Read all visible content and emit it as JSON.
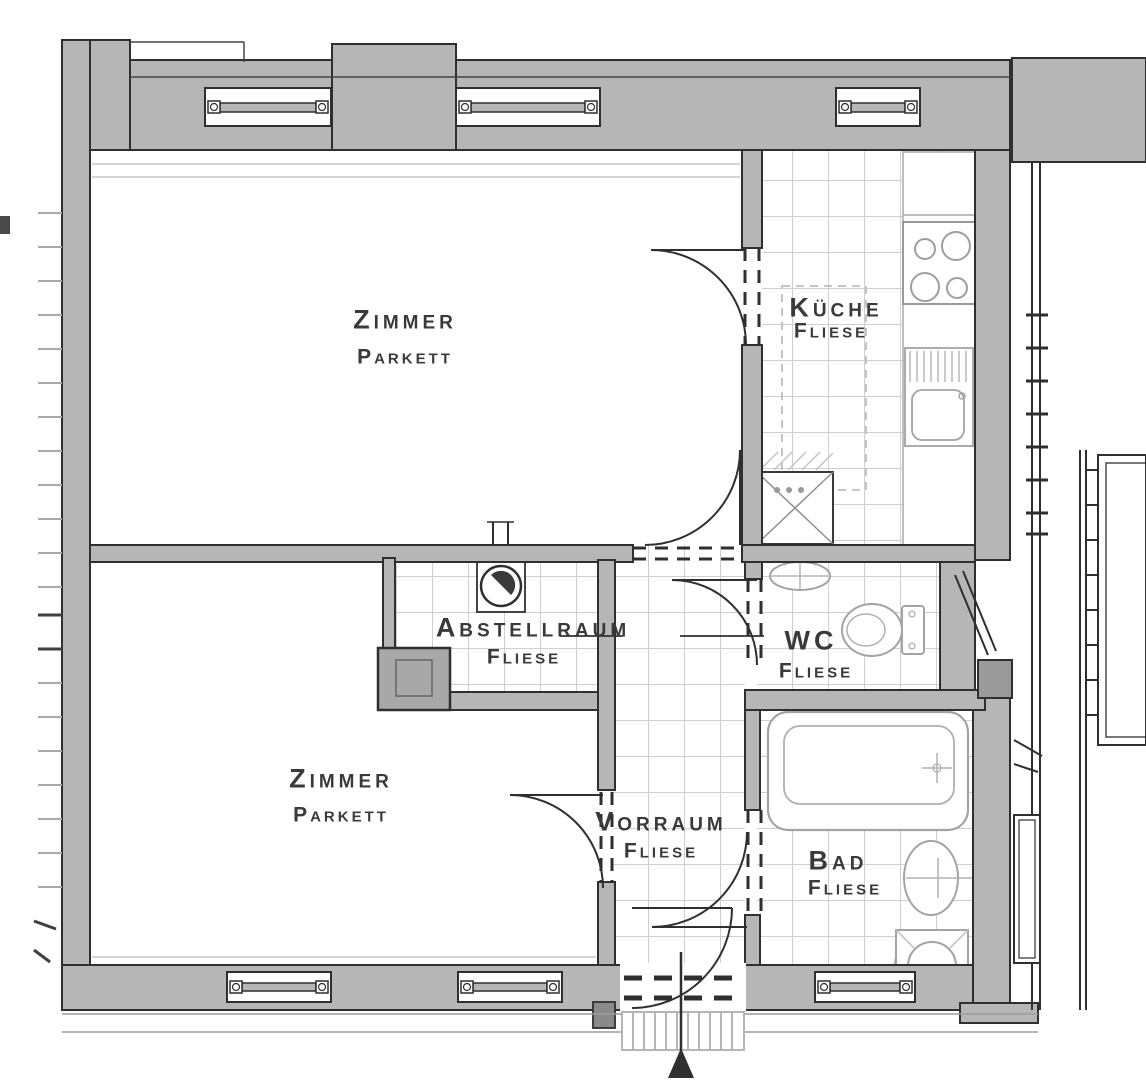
{
  "floorplan": {
    "title": "Wohnung Grundriss",
    "rooms": [
      {
        "id": "zimmer-top",
        "name": "Zimmer",
        "floor": "Parkett"
      },
      {
        "id": "kueche",
        "name": "Küche",
        "floor": "Fliese"
      },
      {
        "id": "abstellraum",
        "name": "Abstellraum",
        "floor": "Fliese"
      },
      {
        "id": "wc",
        "name": "WC",
        "floor": "Fliese"
      },
      {
        "id": "vorraum",
        "name": "Vorraum",
        "floor": "Fliese"
      },
      {
        "id": "zimmer-bottom",
        "name": "Zimmer",
        "floor": "Parkett"
      },
      {
        "id": "bad",
        "name": "Bad",
        "floor": "Fliese"
      }
    ],
    "fixtures": [
      "stove",
      "kitchen-counter",
      "kitchen-sink",
      "shaft",
      "boiler",
      "chimney",
      "wc-sink",
      "toilet",
      "bathtub",
      "bad-sink",
      "washing-machine",
      "doormat",
      "entrance-arrow"
    ],
    "entrance": {
      "symbol": "arrow-up"
    },
    "colors": {
      "wall_fill": "#b6b6b6",
      "outline": "#2f2f2f",
      "tile_line": "#cfcfcf",
      "fixture_line": "#a3a3a3",
      "label_text": "#3a3a3a",
      "background": "#ffffff"
    }
  }
}
